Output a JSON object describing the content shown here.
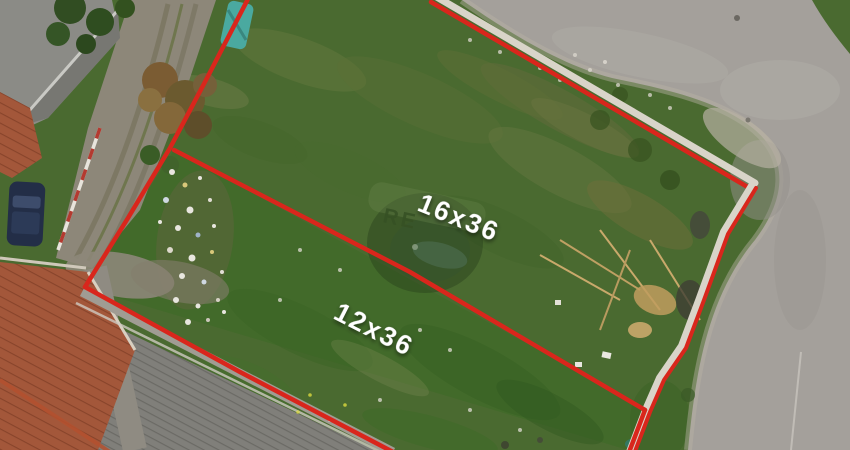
{
  "scene": {
    "description": "Aerial drone photograph of a vacant grass land parcel outlined with red boundary lines, divided into two lots, surrounded by streets, house roofs and a large warehouse roof",
    "labels": {
      "upper_lot": "16x36",
      "lower_lot": "12x36"
    },
    "watermark": {
      "text": "RE"
    },
    "colors": {
      "boundary_line": "#D9261C",
      "boundary_wall_white": "#D9D4C9",
      "label_text": "#FFFFFF",
      "grass_base": "#4A6A30",
      "road_asphalt": "#A4A09B",
      "warehouse_roof": "#84837E",
      "tile_roof": "#A3573A",
      "dirt_driveway": "#8D8779"
    }
  }
}
